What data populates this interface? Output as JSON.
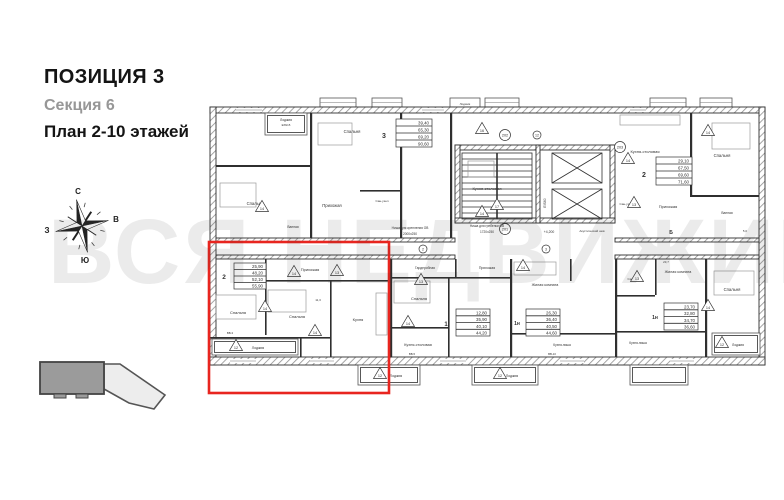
{
  "title_block": {
    "position": "ПОЗИЦИЯ 3",
    "section": "Секция 6",
    "floors": "План 2-10 этажей"
  },
  "compass": {
    "north": "С",
    "south": "Ю",
    "west": "З",
    "east": "В"
  },
  "watermark": "ВСЯ НЕДВИЖИМОСТЬ",
  "colors": {
    "highlight_red": "#e8251f",
    "wall_gray": "#2f2f2f",
    "watermark_gray": "#e3e3e3"
  },
  "plan": {
    "rooms": {
      "bedroom": "Спальня",
      "kitchen_dining": "Кухня-столовая",
      "kitchen": "Кухня",
      "kitchen_niche": "Кухня-ниша",
      "hall": "Прихожая",
      "loggia": "Лоджия",
      "bath": "Ванная",
      "san": "Сан-узел",
      "wardrobe": "Гардеробная",
      "living": "Жилая комната"
    },
    "apartments": {
      "a3": {
        "id": "3",
        "areas": [
          "39,40",
          "65,30",
          "69,20",
          "90,60"
        ]
      },
      "a2_top": {
        "id": "2",
        "areas": [
          "29,10",
          "67,50",
          "69,60",
          "71,60"
        ]
      },
      "a2_red": {
        "id": "2",
        "areas": [
          "25,90",
          "48,20",
          "52,10",
          "55,90"
        ]
      },
      "a1": {
        "id": "1",
        "areas": [
          "12,80",
          "35,90",
          "40,10",
          "44,20"
        ]
      },
      "a1n_mid": {
        "id": "1н",
        "areas": [
          "26,30",
          "36,40",
          "40,50",
          "44,60"
        ]
      },
      "a1n_right": {
        "id": "1н",
        "areas": [
          "23,70",
          "32,80",
          "34,70",
          "36,60"
        ]
      }
    },
    "entries": {
      "m201": "201",
      "m202": "202",
      "m203": "203"
    },
    "axis": {
      "n2": "2",
      "n3": "3",
      "n12": "12"
    },
    "vents": {
      "v12": "12",
      "v13": "13",
      "v14": "14",
      "v16": "16",
      "v17": "17"
    },
    "notes": {
      "niche_mount_1": "Ниша для крепления ОВ",
      "niche_mount_2": "2000х250",
      "niche_comb_1": "Ниша для гребенки ОВ",
      "niche_comb_2": "1720х250",
      "level": "+4,200",
      "fire": "EIS60",
      "loggia_fire": "EIW15",
      "acoustic": "Акустический шов",
      "b_mark": "Б"
    },
    "dims": {
      "d1": "11,3",
      "d2": "23,7",
      "d3": "5,0"
    },
    "codes": {
      "c1": "ВВ-3",
      "c2": "ВВ-10",
      "c3": "ВВ-5"
    }
  }
}
